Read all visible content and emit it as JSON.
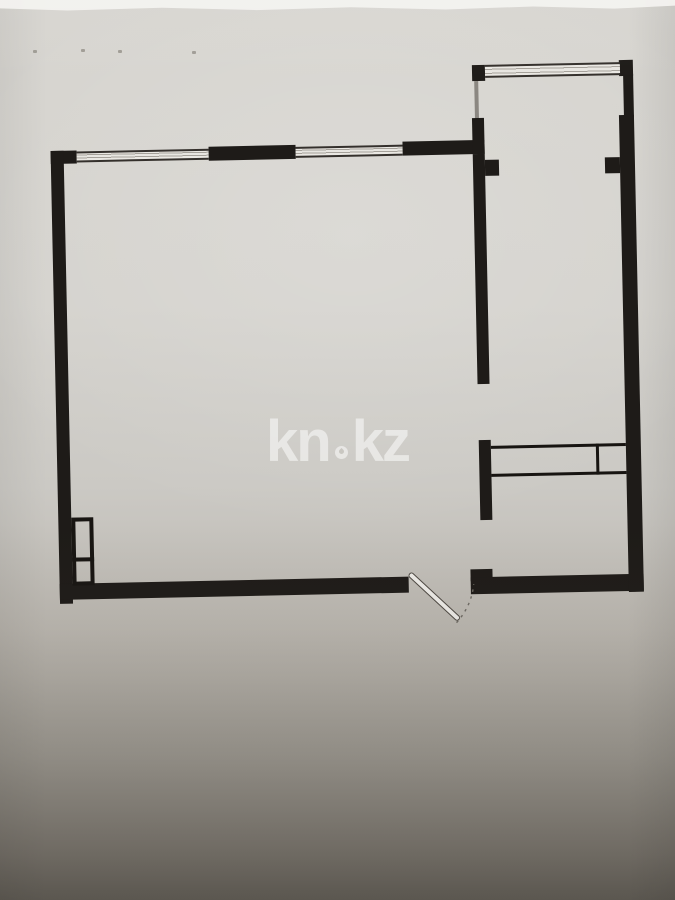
{
  "watermark": {
    "full_text": "kn.kz",
    "text_before_dot": "kn",
    "text_after_dot": "kz",
    "separator_icon": "droplet-icon",
    "color": "#e3e2dd"
  },
  "plan": {
    "type": "floor-plan",
    "rooms_visible": [
      "main-room",
      "balcony",
      "side-room"
    ],
    "features": [
      "windows-top-wall",
      "balcony-window",
      "entry-door-with-swing-arc",
      "built-in-closet",
      "ventilation-shaft"
    ],
    "wall_color": "#1e1b18",
    "window_fill": "#eae8e3"
  },
  "paper": {
    "background_top": "#d7d5d0",
    "background_bottom": "#6f6b63",
    "torn_edge_color": "#f4f3f0"
  }
}
